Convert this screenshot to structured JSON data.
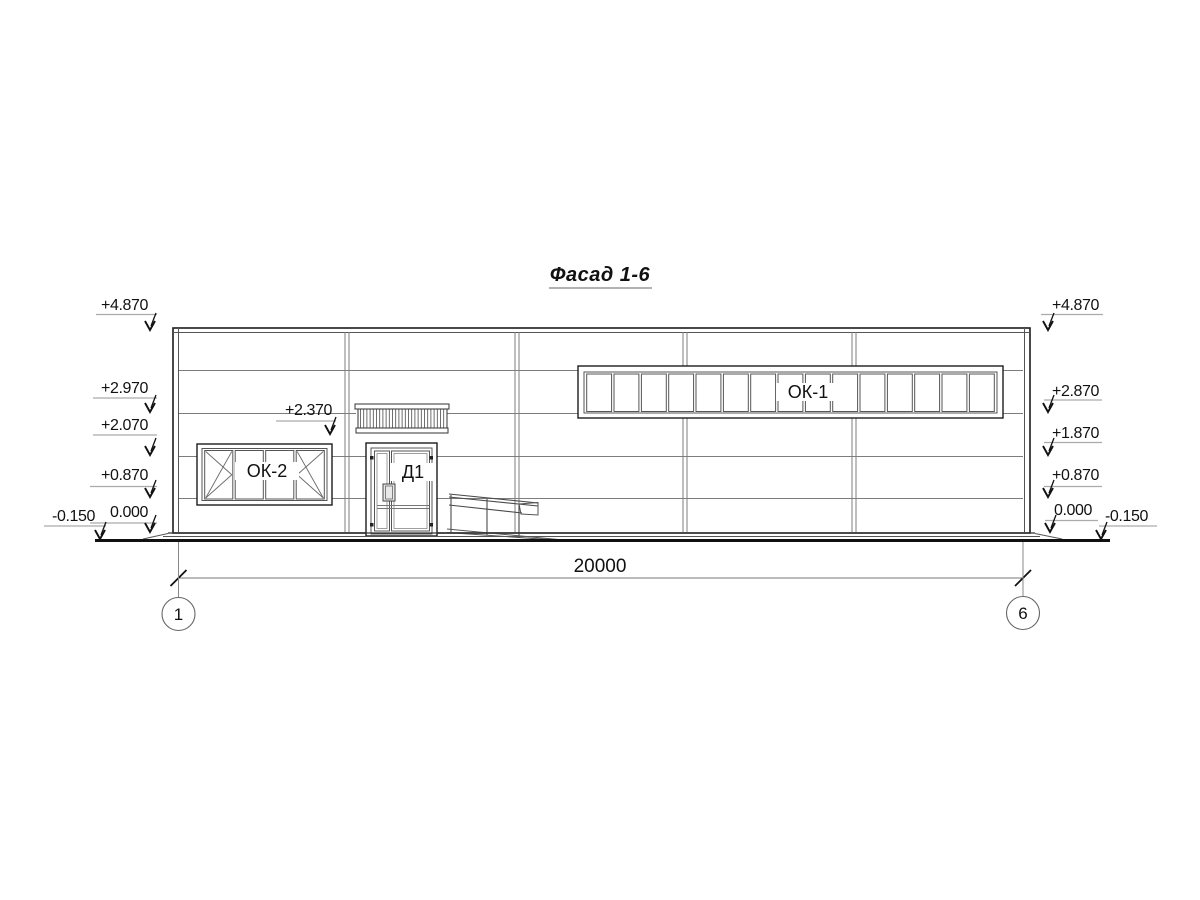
{
  "title": "Фасад 1-6",
  "levels": {
    "left": [
      {
        "value": "+4.870"
      },
      {
        "value": "+2.970"
      },
      {
        "value": "+2.070"
      },
      {
        "value": "+0.870"
      },
      {
        "value": "0.000"
      },
      {
        "value": "-0.150"
      }
    ],
    "right": [
      {
        "value": "+4.870"
      },
      {
        "value": "+2.870"
      },
      {
        "value": "+1.870"
      },
      {
        "value": "+0.870"
      },
      {
        "value": "0.000"
      },
      {
        "value": "-0.150"
      }
    ],
    "canopy": {
      "value": "+2.370"
    }
  },
  "elements": {
    "ribbon_window": {
      "label": "ОК-1",
      "panes": 15
    },
    "left_window": {
      "label": "ОК-2",
      "panes": 4
    },
    "door": {
      "label": "Д1"
    }
  },
  "dimensions": {
    "overall_width": "20000"
  },
  "axes": {
    "start": "1",
    "end": "6"
  }
}
